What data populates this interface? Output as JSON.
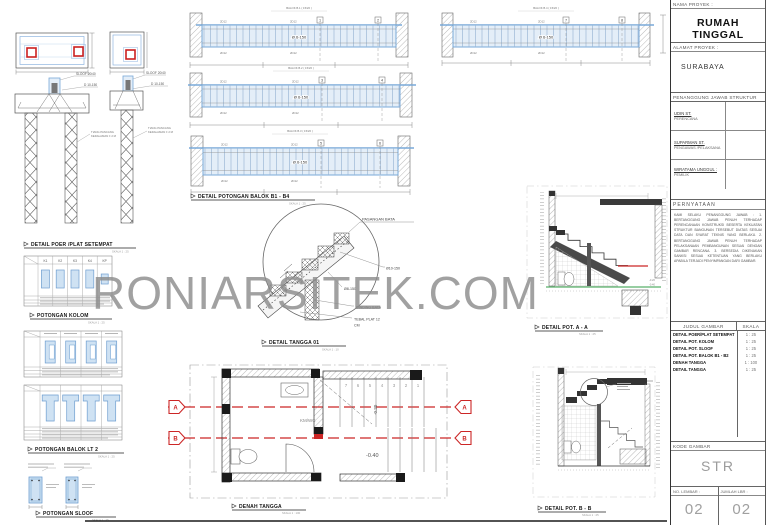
{
  "watermark": "RONIARSITEK.COM",
  "titleblock": {
    "nama_proyek_label": "NAMA PROYEK :",
    "nama_proyek": "RUMAH TINGGAL",
    "alamat_label": "ALAMAT PROYEK :",
    "alamat": "SURABAYA",
    "penanggung_label": "PENANGGUNG JAWAB STRUKTUR",
    "people": [
      {
        "name": "UDIN ST.",
        "role": "PERENCANA"
      },
      {
        "name": "SUPARMAN ST.",
        "role": "PENGAWAS /PELAKSANA"
      },
      {
        "name": "WIRATAMA UNGGUL :",
        "role": "PEMILIK"
      }
    ],
    "pernyataan_label": "PERNYATAAN",
    "pernyataan_text": "KAMI SELAKU PENANGGUNG JAWAB : 1. BERTANGGUNG JAWAB PENUH TERHADAP PERENCANAAN KONSTRUKSI BESERTA KEKUATAN STRUKTUR BANGUNAN TERSEBUT DIATAS SESUAI DATA DAN SYARAT TEKNIS YANG BERLAKU. 2. BERTANGGUNG JAWAB PENUH TERHADAP PELAKSANAAN PEMBANGUNAN SESUAI DENGAN GAMBAR RENCANA. 3. BERSEDIA DIKENAKAN SANKSI SESUAI KETENTUAN YANG BERLAKU APABILA TERJADI PENYIMPANGAN DARI GAMBAR.",
    "judul_label": "JUDUL GAMBAR",
    "skala_label": "SKALA",
    "drawings": [
      {
        "title": "DETAIL POER/PLAT  SETEMPAT",
        "scale": "1 : 25"
      },
      {
        "title": "DETAIL POT. KOLOM",
        "scale": "1 : 25"
      },
      {
        "title": "DETAIL POT. SLOOF",
        "scale": "1 : 25"
      },
      {
        "title": "DETAIL POT. BALOK B1 - B2",
        "scale": "1 : 25"
      },
      {
        "title": "DENAH TANGGA",
        "scale": "1 : 100"
      },
      {
        "title": "DETAIL TANGGA",
        "scale": "1 : 25"
      }
    ],
    "kode_label": "KODE GAMBAR",
    "kode": "STR",
    "no_lembar_label": "NO. LEMBAR :",
    "no_lembar": "02",
    "jumlah_label": "JUMLAH LBR :",
    "jumlah": "02"
  },
  "sections": {
    "detail_poer": "DETAIL POER /PLAT SETEMPAT",
    "potongan_kolom": "POTONGAN KOLOM",
    "potongan_balok_lt2": "POTONGAN BALOK LT 2",
    "potongan_sloof": "POTONGAN SLOOF",
    "detail_potongan_balok": "DETAIL POTONGAN BALOK B1 - B4",
    "detail_tangga": "DETAIL TANGGA 01",
    "denah_tangga": "DENAH TANGGA",
    "pot_aa": "DETAIL POT. A - A",
    "pot_bb": "DETAIL POT. B - B"
  },
  "scales": {
    "s25": "SKALA 1 : 25",
    "s10": "SKALA 1 : 10",
    "s100": "SKALA 1 : 100"
  },
  "ann": {
    "sloof_2040": "SLOOF  20/40",
    "d10_150": "D 10-150",
    "tiang_1": "TIANG PANCANG",
    "tiang_2": "KEDALAMAN ± 2 M",
    "pasangan_bata": "PASANGAN BATA",
    "d10": "Ø10-150",
    "d8": "Ø8-150",
    "dinding_bata": "DINDING BATA",
    "tebal_plat_1": "TEBAL PLAT 12",
    "tebal_plat_2": "CM",
    "stirrup": "Ø 6-150",
    "rebar": "2D12",
    "km_wc": "KM/WC",
    "lvl_020": "-0.20",
    "lvl_040": "-0.40"
  },
  "beams": [
    {
      "label": "BALOK B.1 ( 15/20 )",
      "m": "1",
      "e": "2"
    },
    {
      "label": "BALOK B.2 ( 15/20 )",
      "m": "3",
      "e": "4"
    },
    {
      "label": "BALOK B.3 ( 15/20 )",
      "m": "5",
      "e": "6"
    },
    {
      "label": "BALOK B.4 ( 15/20 )",
      "m": "7",
      "e": "8"
    }
  ],
  "kolom_headers": [
    "K1",
    "K2",
    "K3",
    "K4",
    "KP"
  ],
  "denah": {
    "stairs": [
      "7",
      "6",
      "5",
      "4",
      "3",
      "2",
      "1"
    ],
    "a": "A",
    "b": "B"
  }
}
